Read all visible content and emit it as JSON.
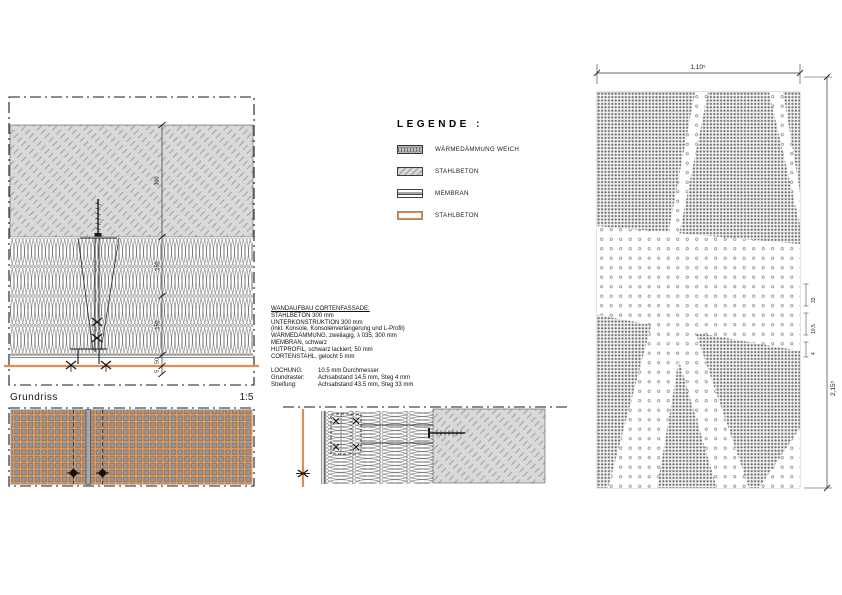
{
  "sheet": {
    "background": "#ffffff"
  },
  "colors": {
    "corten_orange": "#DD8F52",
    "panel_orange": "#E29A5E",
    "concrete_gray": "#D9D9D9",
    "line_black": "#1A1A1A"
  },
  "plan": {
    "caption": "Grundriss",
    "scale": "1:5",
    "dims": [
      "300",
      "150",
      "150",
      "50",
      "5"
    ]
  },
  "legend": {
    "title": "LEGENDE :",
    "items": [
      {
        "label": "WÄRMEDÄMMUNG WEICH"
      },
      {
        "label": "STAHLBETON"
      },
      {
        "label": "MEMBRAN"
      },
      {
        "label": "STAHLBETON"
      }
    ]
  },
  "spec": {
    "title": "WANDAUFBAU CORTENFASSADE:",
    "lines": [
      "STAHLBETON 300 mm",
      "UNTERKONSTRUKTION 300 mm",
      "(inkl. Konsole, Konsolenverlängerung und L-Profil)",
      "WÄRMEDÄMMUNG, zweilagig, λ 035, 300 mm",
      "MEMBRAN, schwarz",
      "HUTPROFIL, schwarz lackiert, 50 mm",
      "CORTENSTAHL, gelocht 5 mm"
    ],
    "perforation": [
      {
        "label": "LOCHUNG:",
        "value": "10.5 mm Durchmesser"
      },
      {
        "label": "Grundraster:",
        "value": "Achsabstand 14.5 mm, Steg 4 mm"
      },
      {
        "label": "Streifung:",
        "value": "Achsabstand 43.5 mm, Steg 33 mm"
      }
    ]
  },
  "elevation": {
    "width_dim": "1,10⁵",
    "height_dim": "2,15⁵",
    "detail_dims": [
      "33",
      "10,5",
      "4"
    ]
  }
}
